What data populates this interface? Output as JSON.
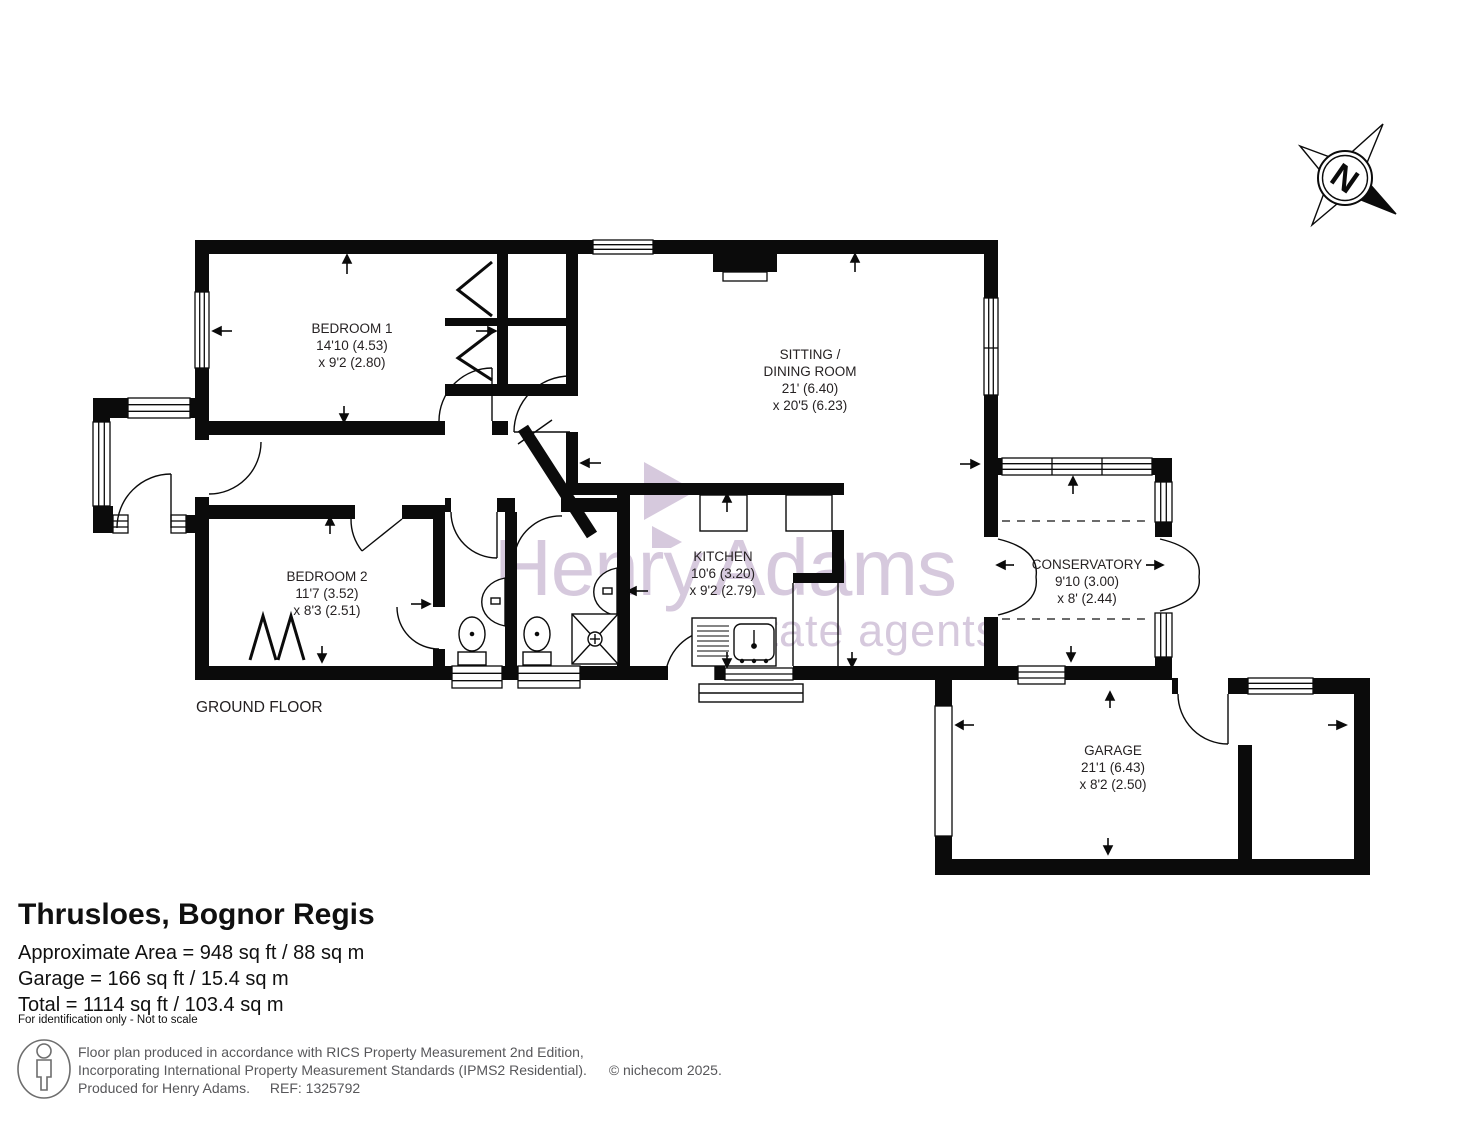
{
  "floorplan": {
    "floor_label": "GROUND FLOOR",
    "compass_letter": "N",
    "rooms": {
      "bedroom1": {
        "name": "BEDROOM 1",
        "dim1": "14'10 (4.53)",
        "dim2": "x 9'2 (2.80)"
      },
      "sitting": {
        "name_line1": "SITTING /",
        "name_line2": "DINING ROOM",
        "dim1": "21' (6.40)",
        "dim2": "x 20'5 (6.23)"
      },
      "bedroom2": {
        "name": "BEDROOM 2",
        "dim1": "11'7 (3.52)",
        "dim2": "x 8'3 (2.51)"
      },
      "kitchen": {
        "name": "KITCHEN",
        "dim1": "10'6 (3.20)",
        "dim2": "x 9'2 (2.79)"
      },
      "conservatory": {
        "name": "CONSERVATORY",
        "dim1": "9'10 (3.00)",
        "dim2": "x 8' (2.44)"
      },
      "garage": {
        "name": "GARAGE",
        "dim1": "21'1 (6.43)",
        "dim2": "x 8'2 (2.50)"
      }
    }
  },
  "watermark": {
    "brand_part1": "Henry",
    "brand_part2": "Adams",
    "tagline": "estate agents",
    "color": "#d6c9dd"
  },
  "summary": {
    "title": "Thrusloes, Bognor Regis",
    "area_line1": "Approximate Area = 948 sq ft / 88 sq m",
    "area_line2": "Garage = 166 sq ft / 15.4 sq m",
    "area_line3": "Total = 1114 sq ft / 103.4 sq m",
    "note": "For identification only - Not to scale"
  },
  "footer": {
    "line1": "Floor plan produced in accordance with RICS Property Measurement 2nd Edition,",
    "line2": "Incorporating International Property Measurement Standards (IPMS2 Residential).",
    "copyright": "© nichecom 2025.",
    "line3": "Produced for Henry Adams.",
    "ref": "REF: 1325792"
  }
}
